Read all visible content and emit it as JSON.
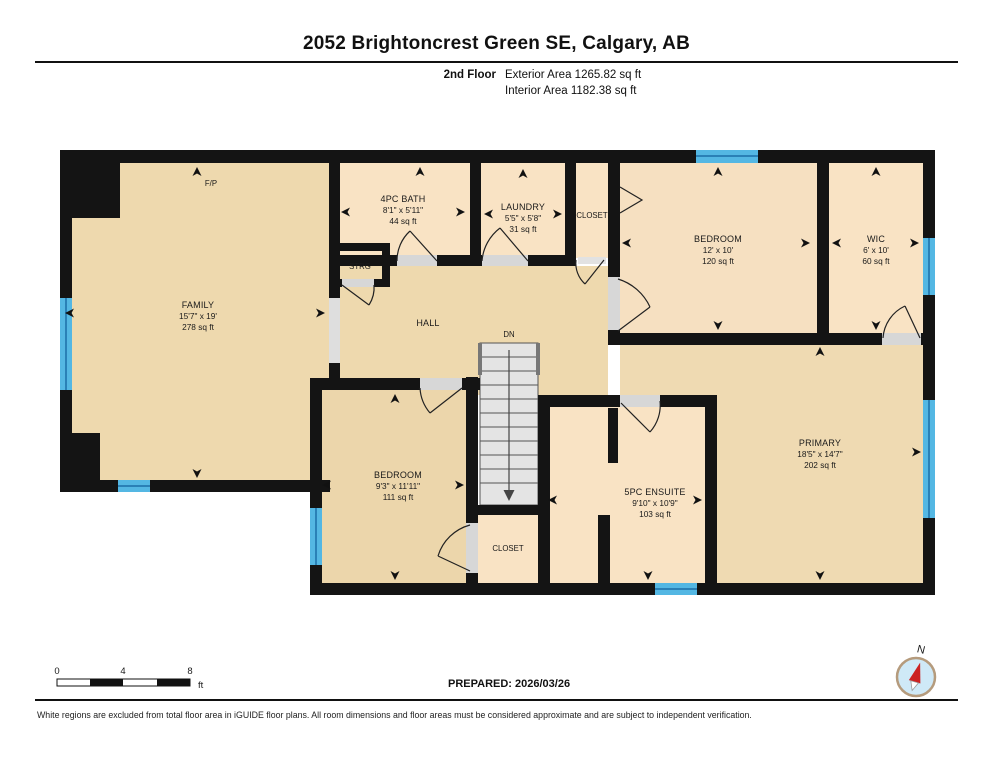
{
  "header": {
    "title": "2052 Brightoncrest Green SE, Calgary, AB",
    "floor_label": "2nd Floor",
    "exterior_area": "Exterior Area 1265.82 sq ft",
    "interior_area": "Interior Area 1182.38 sq ft"
  },
  "rooms": [
    {
      "id": "family",
      "name": "FAMILY",
      "dims": "15'7\" x 19'",
      "area": "278 sq ft"
    },
    {
      "id": "bath",
      "name": "4PC BATH",
      "dims": "8'1\" x 5'11\"",
      "area": "44 sq ft"
    },
    {
      "id": "laundry",
      "name": "LAUNDRY",
      "dims": "5'5\" x 5'8\"",
      "area": "31 sq ft"
    },
    {
      "id": "closet-upper",
      "name": "CLOSET"
    },
    {
      "id": "strg",
      "name": "STRG"
    },
    {
      "id": "bedroom-upper",
      "name": "BEDROOM",
      "dims": "12' x 10'",
      "area": "120 sq ft"
    },
    {
      "id": "wic",
      "name": "WIC",
      "dims": "6' x 10'",
      "area": "60 sq ft"
    },
    {
      "id": "hall",
      "name": "HALL"
    },
    {
      "id": "stairs",
      "name": "DN"
    },
    {
      "id": "bedroom-lower",
      "name": "BEDROOM",
      "dims": "9'3\" x 11'11\"",
      "area": "111 sq ft"
    },
    {
      "id": "closet-lower",
      "name": "CLOSET"
    },
    {
      "id": "ensuite",
      "name": "5PC ENSUITE",
      "dims": "9'10\" x 10'9\"",
      "area": "103 sq ft"
    },
    {
      "id": "primary",
      "name": "PRIMARY",
      "dims": "18'5\" x 14'7\"",
      "area": "202 sq ft"
    },
    {
      "id": "fireplace",
      "name": "F/P"
    }
  ],
  "footer": {
    "scale": {
      "tick0": "0",
      "tick1": "4",
      "tick2": "8",
      "unit": "ft"
    },
    "prepared": "PREPARED: 2026/03/26",
    "disclaimer": "White regions are excluded from total floor area in iGUIDE floor plans. All room dimensions and floor areas must be considered approximate and are subject to independent verification."
  },
  "compass": {
    "north_label": "N"
  },
  "colors": {
    "room_tan": "#eed9ae",
    "room_peach": "#f9e3c4",
    "window_blue": "#54b7e3",
    "wall_black": "#141414",
    "stair_gray": "#e4e4e4"
  }
}
